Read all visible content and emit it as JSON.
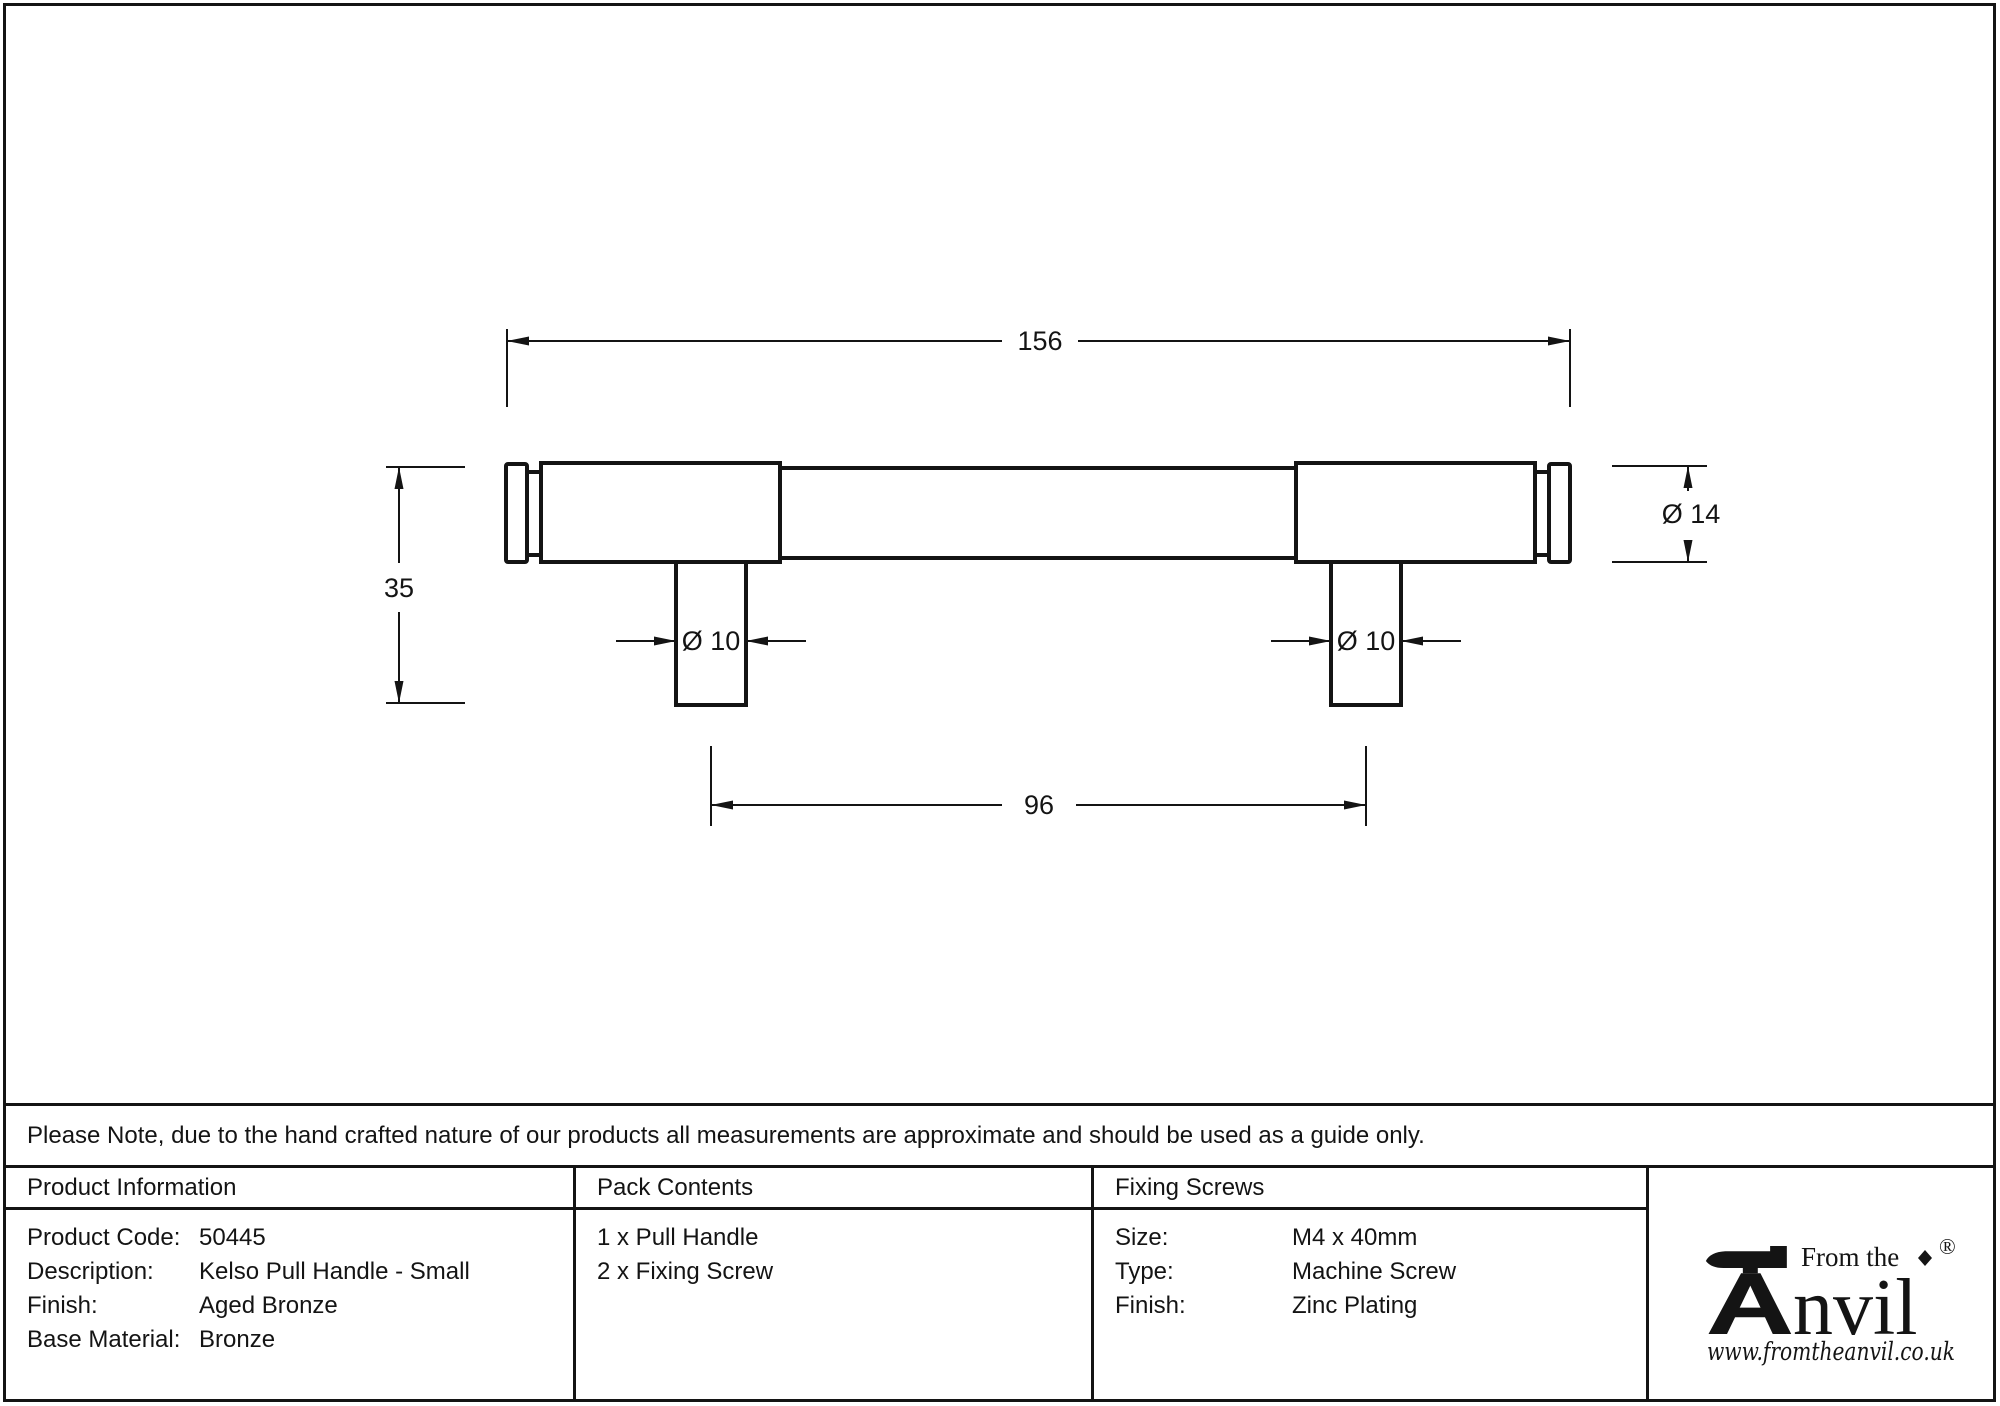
{
  "colors": {
    "ink": "#141414",
    "paper": "#ffffff"
  },
  "drawing": {
    "overall_length": "156",
    "projection_height": "35",
    "end_diameter": "Ø 14",
    "post_diameter_left": "Ø 10",
    "post_diameter_right": "Ø 10",
    "fixing_centres": "96"
  },
  "note": {
    "text": "Please Note, due to the hand crafted nature of our products all measurements are approximate and should be used as a guide only."
  },
  "table": {
    "product_info": {
      "header": "Product Information",
      "rows": [
        {
          "label": "Product Code:",
          "value": "50445"
        },
        {
          "label": "Description:",
          "value": "Kelso Pull Handle - Small"
        },
        {
          "label": "Finish:",
          "value": "Aged Bronze"
        },
        {
          "label": "Base Material:",
          "value": "Bronze"
        }
      ]
    },
    "pack_contents": {
      "header": "Pack Contents",
      "rows": [
        "1 x Pull Handle",
        "2 x Fixing Screw"
      ]
    },
    "fixing_screws": {
      "header": "Fixing Screws",
      "rows": [
        {
          "label": "Size:",
          "value": "M4 x 40mm"
        },
        {
          "label": "Type:",
          "value": "Machine Screw"
        },
        {
          "label": "Finish:",
          "value": "Zinc Plating"
        }
      ]
    }
  },
  "logo": {
    "tagline": "From the",
    "brand": "Anvil",
    "brand_rest": "nvil",
    "registered": "®",
    "website": "www.fromtheanvil.co.uk"
  }
}
